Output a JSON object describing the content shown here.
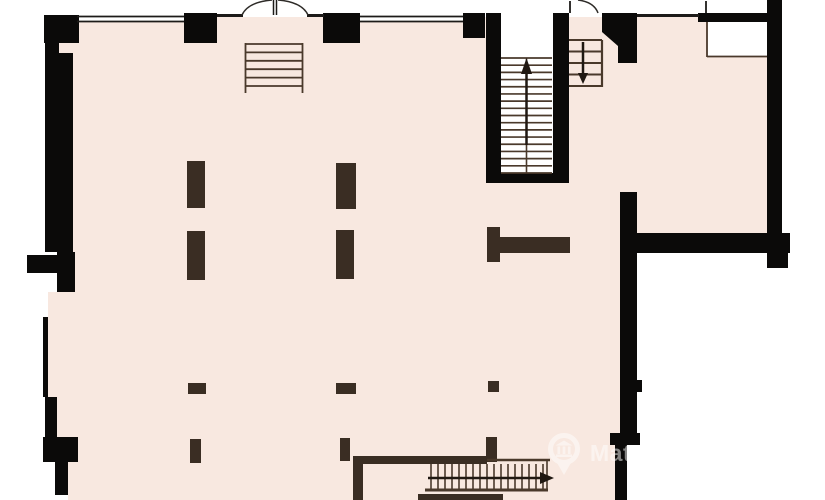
{
  "canvas": {
    "width": 825,
    "height": 500
  },
  "colors": {
    "background": "#ffffff",
    "floor": "#f8e8e0",
    "wall": "#0b0a09",
    "timber": "#3a2d23",
    "thinwall": "#1d1b19",
    "line": "#4a392b",
    "arrow": "#201812",
    "door": "#2e2b28",
    "watermark": "#ffffff"
  },
  "watermark": {
    "text": "MatchOffice",
    "opacity": 0.5,
    "icon": "location-pin-building-icon"
  },
  "floorplan": {
    "layers": [
      {
        "name": "floor-area",
        "fill": "floor",
        "rects": [
          [
            48,
            17,
            589,
            483
          ],
          [
            637,
            17,
            130,
            216
          ]
        ]
      },
      {
        "name": "white-patches",
        "fill": "background",
        "rects": [
          [
            627,
            445,
            10,
            55
          ],
          [
            48,
            252,
            10,
            40
          ],
          [
            48,
            462,
            20,
            38
          ],
          [
            501,
            15,
            58,
            24
          ],
          [
            501,
            15,
            52,
            159
          ],
          [
            707,
            22,
            60,
            35
          ],
          [
            77,
            13,
            107,
            9
          ],
          [
            360,
            13,
            103,
            9
          ]
        ]
      },
      {
        "name": "walls",
        "fill": "wall",
        "rects": [
          [
            44,
            15,
            35,
            28
          ],
          [
            45,
            15,
            28,
            237
          ],
          [
            27,
            255,
            31,
            18
          ],
          [
            57,
            252,
            18,
            40
          ],
          [
            43,
            317,
            5,
            80
          ],
          [
            45,
            397,
            12,
            65
          ],
          [
            43,
            437,
            35,
            25
          ],
          [
            55,
            462,
            13,
            33
          ],
          [
            184,
            13,
            33,
            30
          ],
          [
            323,
            13,
            37,
            30
          ],
          [
            463,
            13,
            22,
            25
          ],
          [
            486,
            13,
            15,
            170
          ],
          [
            553,
            13,
            16,
            170
          ],
          [
            486,
            173,
            83,
            10
          ],
          [
            698,
            13,
            69,
            9
          ],
          [
            767,
            0,
            15,
            238
          ],
          [
            637,
            233,
            153,
            20
          ],
          [
            767,
            253,
            21,
            15
          ],
          [
            620,
            192,
            17,
            248
          ],
          [
            637,
            380,
            5,
            12
          ],
          [
            610,
            433,
            30,
            12
          ],
          [
            615,
            445,
            12,
            55
          ]
        ],
        "polys": [
          [
            [
              602,
              13
            ],
            [
              637,
              13
            ],
            [
              637,
              63
            ],
            [
              618,
              63
            ],
            [
              618,
              46
            ],
            [
              602,
              32
            ]
          ]
        ]
      },
      {
        "name": "floor-notch",
        "fill": "floor",
        "rects": [
          [
            59,
            43,
            18,
            10
          ]
        ]
      },
      {
        "name": "timber-walls",
        "fill": "timber",
        "rects": [
          [
            353,
            456,
            134,
            8
          ],
          [
            353,
            456,
            10,
            44
          ],
          [
            418,
            494,
            85,
            6
          ],
          [
            487,
            227,
            13,
            35
          ],
          [
            487,
            237,
            83,
            16
          ]
        ]
      },
      {
        "name": "columns",
        "fill": "timber",
        "rects": [
          [
            187,
            161,
            18,
            47
          ],
          [
            336,
            163,
            20,
            46
          ],
          [
            187,
            231,
            18,
            49
          ],
          [
            336,
            230,
            18,
            49
          ],
          [
            188,
            383,
            18,
            11
          ],
          [
            336,
            383,
            20,
            11
          ],
          [
            488,
            381,
            11,
            11
          ],
          [
            190,
            439,
            11,
            24
          ],
          [
            340,
            438,
            10,
            23
          ],
          [
            486,
            437,
            11,
            25
          ]
        ]
      },
      {
        "name": "wall-lines",
        "stroke": "thinwall",
        "lines": [
          [
            217,
            15.5,
            243,
            15.5,
            3
          ],
          [
            307,
            15.5,
            324,
            15.5,
            3
          ],
          [
            637,
            15.5,
            699,
            15.5,
            3
          ],
          [
            77,
            16.5,
            184,
            16.5,
            1.8
          ],
          [
            77,
            21.5,
            184,
            21.5,
            1.8
          ],
          [
            360,
            16.5,
            463,
            16.5,
            1.8
          ],
          [
            360,
            21.5,
            463,
            21.5,
            1.8
          ],
          [
            570,
            1,
            570,
            13,
            1.8
          ],
          [
            706,
            1,
            706,
            13,
            1.8
          ],
          [
            273.5,
            0,
            273.5,
            15,
            1.5
          ],
          [
            276.5,
            0,
            276.5,
            15,
            1.5
          ]
        ]
      },
      {
        "name": "detail-lines",
        "stroke": "line",
        "lines": [
          [
            707,
            22,
            707,
            57,
            1.8
          ],
          [
            707,
            56.5,
            767,
            56.5,
            1.8
          ],
          [
            526.5,
            58,
            526.5,
            173,
            1.6
          ],
          [
            602,
            40,
            602,
            87,
            2.2
          ],
          [
            487,
            460,
            550,
            460,
            2.5
          ],
          [
            547,
            461,
            547,
            489,
            1.6
          ],
          [
            425,
            490,
            548,
            490,
            3
          ],
          [
            245.5,
            43,
            245.5,
            93,
            1.8
          ],
          [
            302.5,
            43,
            302.5,
            93,
            1.8
          ]
        ]
      },
      {
        "name": "stairwell-main-treads",
        "stroke": "line",
        "treads": [
          {
            "axis": "h",
            "x1": 501,
            "x2": 552,
            "from": 58,
            "to": 173,
            "n": 17,
            "w": 1.7
          }
        ]
      },
      {
        "name": "stair-upper-right-treads",
        "stroke": "line",
        "treads": [
          {
            "axis": "h",
            "x1": 569,
            "x2": 602,
            "from": 40,
            "to": 86,
            "n": 5,
            "w": 2
          }
        ]
      },
      {
        "name": "stair-bottom-treads",
        "stroke": "line",
        "treads": [
          {
            "axis": "v",
            "y1": 464,
            "y2": 489,
            "from": 431,
            "to": 543,
            "n": 17,
            "w": 1.6
          }
        ]
      },
      {
        "name": "wall-ladder-rungs",
        "stroke": "line",
        "treads": [
          {
            "axis": "h",
            "x1": 245,
            "x2": 303,
            "from": 44,
            "to": 86,
            "n": 6,
            "w": 1.8
          }
        ]
      },
      {
        "name": "direction-arrows",
        "stroke": "arrow",
        "arrows": [
          {
            "shaft": [
              526.5,
              145,
              526.5,
              72
            ],
            "head": [
              [
                526.5,
                58
              ],
              [
                521,
                74
              ],
              [
                532,
                74
              ]
            ],
            "w": 2.5
          },
          {
            "shaft": [
              583,
              42,
              583,
              74
            ],
            "head": [
              [
                583,
                84
              ],
              [
                578,
                73
              ],
              [
                588,
                73
              ]
            ],
            "w": 2.5
          },
          {
            "shaft": [
              428,
              478,
              540,
              478
            ],
            "head": [
              [
                554,
                478
              ],
              [
                540,
                472
              ],
              [
                540,
                484
              ]
            ],
            "w": 2.5
          }
        ]
      },
      {
        "name": "door-swing-arcs",
        "stroke": "door",
        "paths": [
          "M 242 15 Q 248 2 272 0",
          "M 308 15 Q 302 2 278 0",
          "M 598 13 Q 594 2 578 0"
        ]
      }
    ]
  }
}
